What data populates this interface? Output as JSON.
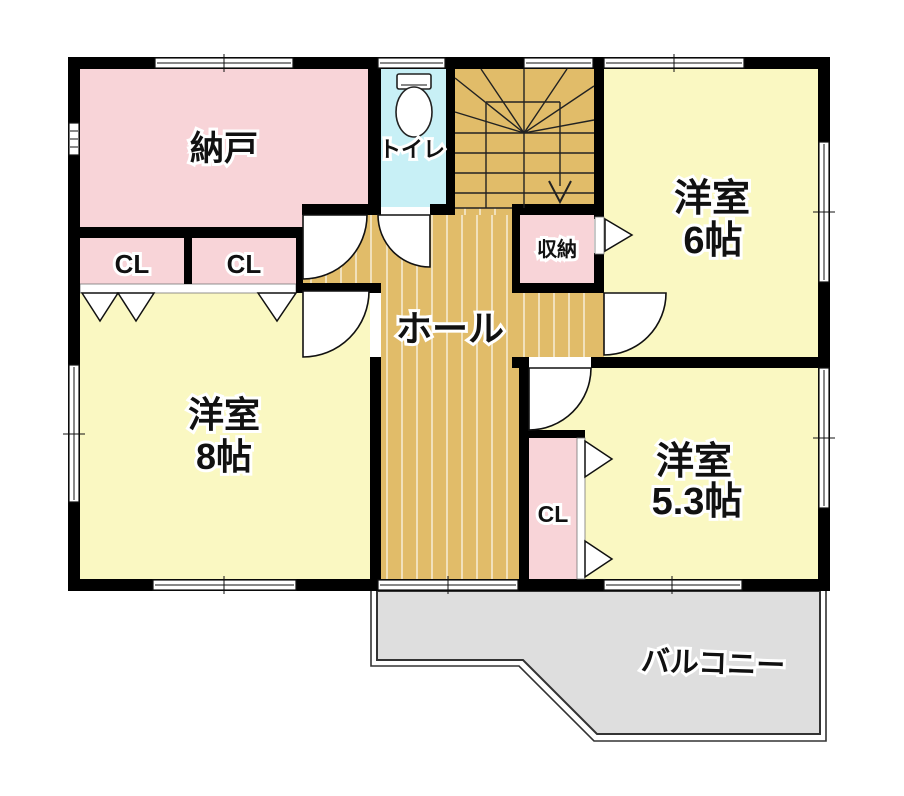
{
  "rooms": {
    "nando": {
      "label": "納戸"
    },
    "toilet": {
      "label": "トイレ"
    },
    "storage": {
      "label": "収納"
    },
    "hall": {
      "label": "ホール"
    },
    "closet_a": {
      "label": "CL"
    },
    "closet_b": {
      "label": "CL"
    },
    "closet_c": {
      "label": "CL"
    },
    "western6": {
      "label": "洋室",
      "size": "6帖"
    },
    "western8": {
      "label": "洋室",
      "size": "8帖"
    },
    "western53": {
      "label": "洋室",
      "size": "5.3帖"
    },
    "balcony": {
      "label": "バルコニー"
    }
  },
  "colors": {
    "wall": "#000000",
    "pink": "#f8d4d8",
    "yellow": "#faf8c2",
    "cyan": "#c8f0f6",
    "tan": "#e1bc69",
    "gray": "#dedede"
  }
}
